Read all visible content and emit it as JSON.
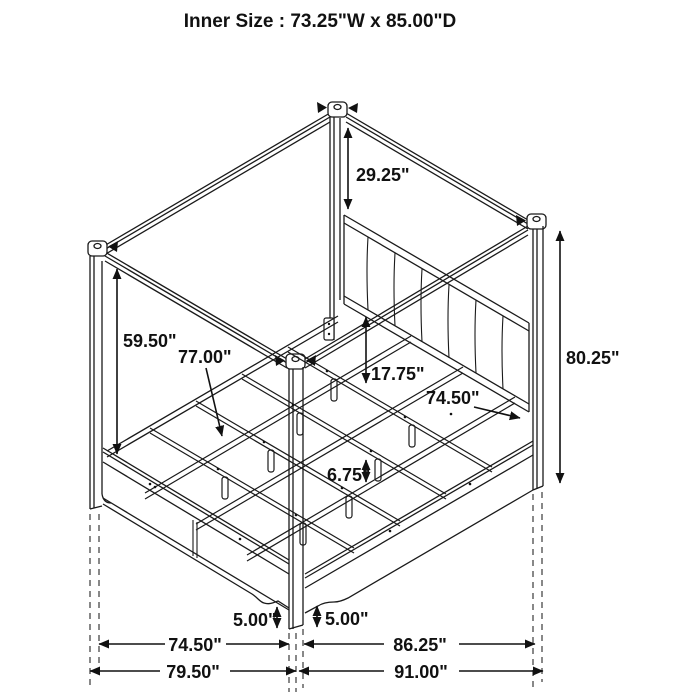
{
  "title": "Inner Size : 73.25\"W x 85.00\"D",
  "colors": {
    "line": "#1a1a1a",
    "background": "#ffffff",
    "dashed": "#3a3a3a",
    "text": "#111111"
  },
  "diagram": {
    "kind": "isometric bed dimension drawing",
    "labels": {
      "title": "Inner Size : 73.25\"W x 85.00\"D",
      "canopy_to_headboard": "29.25\"",
      "canopy_to_footboard": "59.50\"",
      "slat_rail_length": "77.00\"",
      "rail_to_slat_drop": "17.75\"",
      "side_rail_length": "74.50\"",
      "post_height": "80.25\"",
      "slat_leg_height": "6.75\"",
      "footboard_floor_clearance": "5.00\"",
      "siderail_floor_clearance": "5.00\"",
      "footboard_span": "74.50\"",
      "side_span": "86.25\"",
      "overall_width": "79.50\"",
      "overall_depth": "91.00\""
    }
  }
}
